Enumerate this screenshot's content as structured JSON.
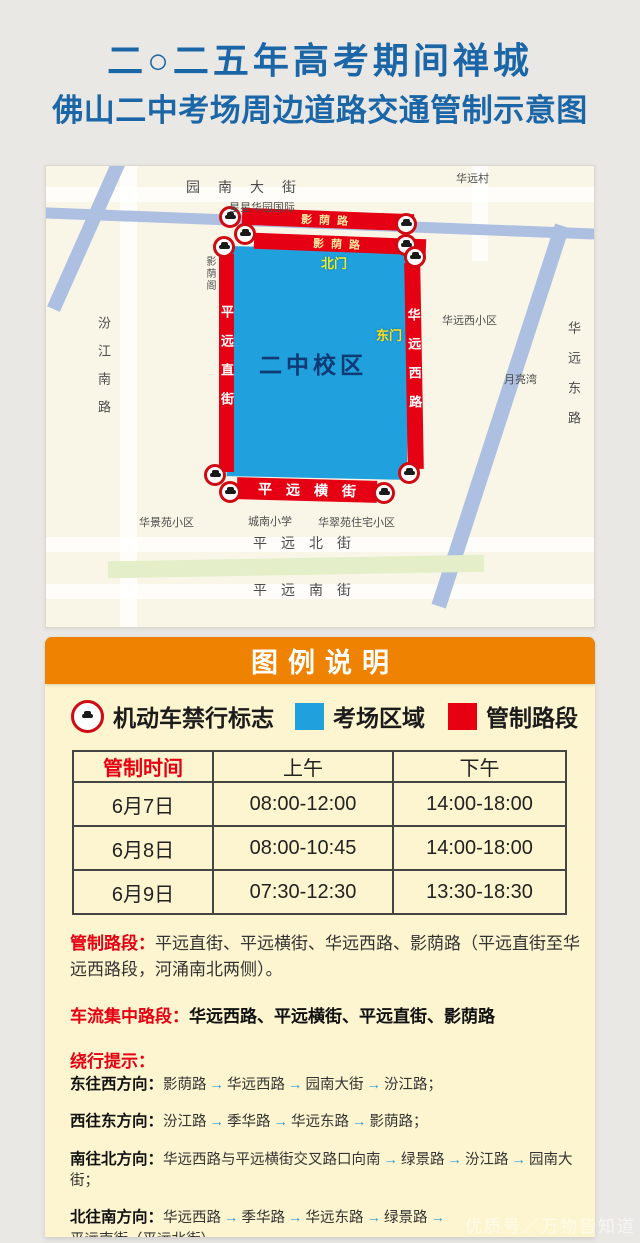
{
  "title": {
    "line1": "二○二五年高考期间禅城",
    "line2": "佛山二中考场周边道路交通管制示意图"
  },
  "colors": {
    "title_blue": "#1b66a7",
    "control_red": "#e60012",
    "campus_blue": "#21a0de",
    "legend_orange": "#ef8200",
    "panel_yellow": "#fcf5cf",
    "arrow_blue": "#2f9cd6",
    "river_blue": "#aec0e2",
    "park_green": "#e4efca",
    "campus_text_navy": "#0f3a74",
    "gate_yellow": "#f2ef2a"
  },
  "map": {
    "streets": {
      "yuan_nan_da_jie": "园南大街",
      "hua_yuan_cun": "华远村",
      "xing_xing_hua_yuan": "星星华园国际",
      "ying_yin_lu_north": "影荫路",
      "ying_yin_lu_south": "影荫路",
      "ying_yin_ge": "影荫阁",
      "fen_jiang_nan_lu": "汾江南路",
      "ping_yuan_zhi_jie": "平远直街",
      "hua_yuan_xi_lu": "华远西路",
      "bei_men": "北门",
      "dong_men": "东门",
      "campus": "二中校区",
      "hua_yuan_xi_xiao_qu": "华远西小区",
      "yue_liang_wan": "月亮湾",
      "hua_yuan_dong_lu": "华远东路",
      "ping_yuan_heng_jie": "平远横街",
      "hua_jing_yuan_xiao_qu": "华景苑小区",
      "cheng_nan_xiao_xue": "城南小学",
      "hua_cui_yuan_xiao_qu": "华翠苑住宅小区",
      "ping_yuan_bei_jie": "平远北街",
      "ping_yuan_nan_jie": "平远南街"
    }
  },
  "legend": {
    "header": "图例说明",
    "items": [
      {
        "icon": "no-entry-icon",
        "label": "机动车禁行标志"
      },
      {
        "icon": "blue-square",
        "label": "考场区域"
      },
      {
        "icon": "red-square",
        "label": "管制路段"
      }
    ]
  },
  "table": {
    "headers": [
      "管制时间",
      "上午",
      "下午"
    ],
    "rows": [
      [
        "6月7日",
        "08:00-12:00",
        "14:00-18:00"
      ],
      [
        "6月8日",
        "08:00-10:45",
        "14:00-18:00"
      ],
      [
        "6月9日",
        "07:30-12:30",
        "13:30-18:30"
      ]
    ]
  },
  "notes": {
    "arrow": "→",
    "controlled_label": "管制路段：",
    "controlled_text": "平远直街、平远横街、华远西路、影荫路（平远直街至华远西路段，河涌南北两侧）。",
    "congestion_label": "车流集中路段：",
    "congestion_text": "华远西路、平远横街、平远直街、影荫路",
    "detour_label": "绕行提示：",
    "detours": [
      {
        "dir": "东往西方向：",
        "steps": [
          "影荫路",
          "华远西路",
          "园南大街",
          "汾江路；"
        ]
      },
      {
        "dir": "西往东方向：",
        "steps": [
          "汾江路",
          "季华路",
          "华远东路",
          "影荫路；"
        ]
      },
      {
        "dir": "南往北方向：",
        "steps": [
          "华远西路与平远横街交叉路口向南",
          "绿景路",
          "汾江路",
          "园南大街；"
        ]
      },
      {
        "dir": "北往南方向：",
        "steps": [
          "华远西路",
          "季华路",
          "华远东路",
          "绿景路",
          "平远南街（平远北街）"
        ]
      }
    ]
  },
  "watermark": "优质号／万物皆知道"
}
